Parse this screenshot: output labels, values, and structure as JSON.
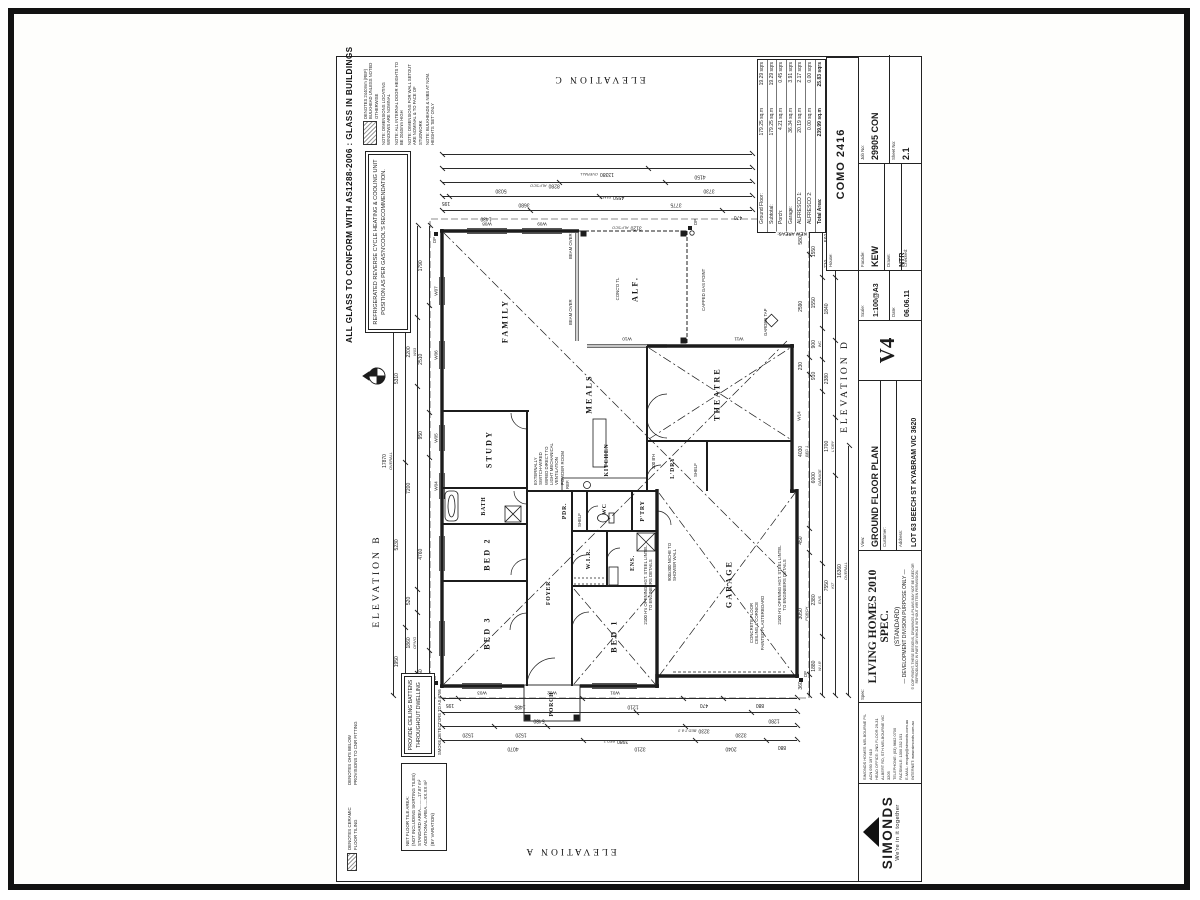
{
  "notes_top": {
    "glass": "ALL GLASS TO CONFORM WITH AS1288-2006 : GLASS IN BUILDINGS",
    "refrigerated": "REFRIGERATED REVERSE CYCLE HEATING & COOLING UNIT POSITION AS PER GAS'N'COOL'S RECOMMENDATION.",
    "bulkhead": "DENOTES 2440mm (REF) BULKHEAD UNLESS NOTED OTHERWISE",
    "windows_nominal": "NOTE: DIMENSIONS LOCATING WINDOWS ARE NOMINAL",
    "door_heights": "NOTE: ALL INTERNAL DOOR HEIGHTS TO BE 2040mm HIGH",
    "wall_setout": "NOTE: DIMENSIONS FOR WALL SETOUT ARE NOMINAL & TO FACE OF STUDWORK",
    "bulkheads_nom": "NOTE: BULKHEADS & NIBS AT NOM. HEIGHTS 'SET' ONLY"
  },
  "notes_left": {
    "tiling_legend": "DENOTES CERAMIC FLOOR TILING",
    "ohs_legend": "DENOTES OH'S BELOW PROVISIONS TO CNR FITTING",
    "battens1": "PROVIDE CEILING BATTENS",
    "battens2": "THROUGHOUT DWELLING",
    "smoke": "SMOKE DETECTORS TO AS 3786",
    "tile_area_title": "NET FLOOR TILE AREA:",
    "tile_area_sub": "(NOT INCLUDING SKIRTING TILES)",
    "tile_std": "STANDARD AREA..........17.87 m²",
    "tile_add": "ADDITIONAL AREA......XX.XX m²",
    "tile_var": "(BY VARIATION)"
  },
  "elevations": {
    "a": "ELEVATION A",
    "b": "ELEVATION B",
    "c": "ELEVATION C",
    "d": "ELEVATION D"
  },
  "plan": {
    "rooms": [
      "BED 3",
      "BED 2",
      "BATH",
      "STUDY",
      "FAMILY",
      "MEALS",
      "THEATRE",
      "KITCHEN",
      "FOYER",
      "PORCH",
      "BED 1",
      "W.I.R.",
      "ENS.",
      "WC",
      "PDR.",
      "P'TRY",
      "L'DRY",
      "GARAGE",
      "ALF."
    ],
    "windows": [
      "W01",
      "W02",
      "W03",
      "W04",
      "W05",
      "W06",
      "W07",
      "W08",
      "W09",
      "W10",
      "W11",
      "W14"
    ],
    "notes": {
      "capped_gas": "CAPPED GAS POINT",
      "beam_over": "BEAM OVER",
      "garage_finish": "CONCRETE FLOOR CEILING & CORNICE PAINTED PLASTERBOARD",
      "niche": "900x300 NICHE TO SHOWER WALL",
      "garage_opening": "2100 H's OPENING HGT. STEEL LINTEL TO ENGINEERS DETAILS",
      "mech_vent": "EXTERNALLY SWITCH-WIRED WIRED DIRECT TO LIGHT MECHANICAL VENTILATION POWDER ROOM",
      "shelf": "SHELF",
      "garden_tap": "GARDEN TAP",
      "conc_tl": "CONC'D TL",
      "bulkhead_300": "300 B'H",
      "ref": "REF.",
      "dp": "DP"
    }
  },
  "dims": {
    "topA": [
      {
        "v": "960"
      },
      {
        "v": "4760"
      },
      {
        "v": "950"
      },
      {
        "v": "2510"
      },
      {
        "v": "1790"
      }
    ],
    "topB": [
      {
        "v": "520",
        "sub": "REF"
      },
      {
        "v": "1860",
        "sub": "OPN'G"
      },
      {
        "v": "520"
      },
      {
        "v": "7200"
      },
      {
        "v": "2200",
        "sub": "W03"
      },
      {
        "v": "3000"
      }
    ],
    "topC": [
      {
        "v": "1950"
      },
      {
        "v": "5230"
      },
      {
        "v": "5310"
      },
      {
        "v": "1960"
      }
    ],
    "topD": [
      {
        "v": "17870",
        "sub": "OVERALL"
      }
    ],
    "botA": [
      {
        "v": "360"
      },
      {
        "v": "3050",
        "sub": "PORCH"
      },
      {
        "v": "450"
      },
      {
        "v": "4030",
        "sub": "BED 1"
      },
      {
        "v": "230"
      },
      {
        "v": "2590"
      },
      {
        "v": "580"
      }
    ],
    "botB": [
      {
        "v": "1880",
        "sub": "W.I.R"
      },
      {
        "v": "2380",
        "sub": "ENS"
      },
      {
        "v": "6000",
        "sub": "GARAGE"
      },
      {
        "v": "910"
      },
      {
        "v": "900",
        "sub": "WC"
      },
      {
        "v": "1550"
      },
      {
        "v": "1550"
      }
    ],
    "botC": [
      {
        "v": "7550",
        "sub": "KIT"
      },
      {
        "v": "1700",
        "sub": "L'DRY"
      },
      {
        "v": "2380"
      },
      {
        "v": "1840"
      },
      {
        "v": "710"
      },
      {
        "v": "560",
        "sub": "REF"
      }
    ],
    "botD": [
      {
        "v": "16360",
        "sub": "OVERALL"
      }
    ],
    "leftA": [
      {
        "v": "195"
      },
      {
        "v": "1485"
      },
      {
        "v": "1210"
      },
      {
        "v": "470"
      },
      {
        "v": "880"
      }
    ],
    "leftB": [
      {
        "v": "5480"
      },
      {
        "v": "3230",
        "sub": "BED 2 & 3"
      },
      {
        "v": "1280"
      }
    ],
    "leftC": [
      {
        "v": "1520"
      },
      {
        "v": "1520"
      },
      {
        "v": "3980",
        "sub": "BED 3"
      },
      {
        "v": "3230"
      }
    ],
    "leftD": [
      {
        "v": "4070"
      },
      {
        "v": "3210"
      },
      {
        "v": "2040"
      },
      {
        "v": "880"
      }
    ],
    "rightA": [
      {
        "v": "1430"
      },
      {
        "v": "3120",
        "sub": "ALF'SCO"
      },
      {
        "v": "470"
      }
    ],
    "rightB": [
      {
        "v": "195"
      },
      {
        "v": "3680"
      },
      {
        "v": "3775"
      }
    ],
    "rightC": [
      {
        "v": "5030"
      },
      {
        "v": "4550",
        "sub": "FAM'Y"
      },
      {
        "v": "3730"
      }
    ],
    "rightD": [
      {
        "v": "8280",
        "sub": "ALF'SCO"
      },
      {
        "v": "4150"
      }
    ],
    "rightE": [
      {
        "v": "13380",
        "sub": "OVERALL"
      }
    ]
  },
  "areas": {
    "title": "KEW AREAS:",
    "rows": [
      {
        "label": "Ground Floor:",
        "sqm": "179.25 sq.m",
        "sqrs": "19.29 sqrs"
      },
      {
        "label": "Subtotal:",
        "sqm": "179.25 sq.m",
        "sqrs": "19.29 sqrs"
      },
      {
        "label": "Porch:",
        "sqm": "4.21 sq.m",
        "sqrs": "0.45 sqrs"
      },
      {
        "label": "Garage:",
        "sqm": "36.34 sq.m",
        "sqrs": "3.91 sqrs"
      },
      {
        "label": "ALFRESCO 1:",
        "sqm": "20.19 sq.m",
        "sqrs": "2.17 sqrs"
      },
      {
        "label": "ALFRESCO 2:",
        "sqm": "0.00 sq.m",
        "sqrs": "0.00 sqrs"
      },
      {
        "label": "Total Area:",
        "sqm": "239.99 sq.m",
        "sqrs": "25.83 sqrs"
      }
    ]
  },
  "titleblock": {
    "logo": {
      "name": "SIMONDS",
      "tagline": "We're in it together"
    },
    "contact": [
      "SIMONDS HOMES MELBOURNE P/L  ACN 050 197 610",
      "HEAD OFFICE: 2ND FLOOR 29-31 ALBERT RD, STH MELBOURNE VIC 3205",
      "TELEPHONE: (03) 9682 0700",
      "FACSIMILE: 1300 232 151",
      "E-MAIL: enquiry@simonds.com.au",
      "INTERNET: www.simonds.com.au"
    ],
    "spec_label": "Spec:",
    "spec": "LIVING HOMES 2010 SPEC.",
    "spec_sub1": "(STANDARD)",
    "spec_sub2": "— DEVELOPMENT DIVISION PURPOSE ONLY —",
    "copyright": "© COPYRIGHT. THESE DESIGNS, DRAWINGS & PLANS MAY NOT BE USED OR REPRODUCED IN PART OR WHOLE WITHOUT WRITTEN PERMISSION.",
    "view_label": "View:",
    "view": "GROUND FLOOR PLAN",
    "customer_label": "Customer:",
    "customer": "",
    "address_label": "Address:",
    "address": "LOT 63 BEECH ST KYABRAM VIC 3620",
    "version": "V4",
    "scale_label": "Scale:",
    "scale": "1:100@A3",
    "date_label": "Date:",
    "date": "06.06.11",
    "house_label": "House:",
    "house": "COMO 2416",
    "facade_label": "Facade:",
    "facade": "KEW",
    "drawn_label": "Drawn:",
    "drawn": "NTR",
    "job_label": "Job No:",
    "job": "29905 CON",
    "checked_label": "Checked:",
    "checked": "",
    "sheetno_label": "Sheet No:",
    "sheetno": "2.1"
  }
}
